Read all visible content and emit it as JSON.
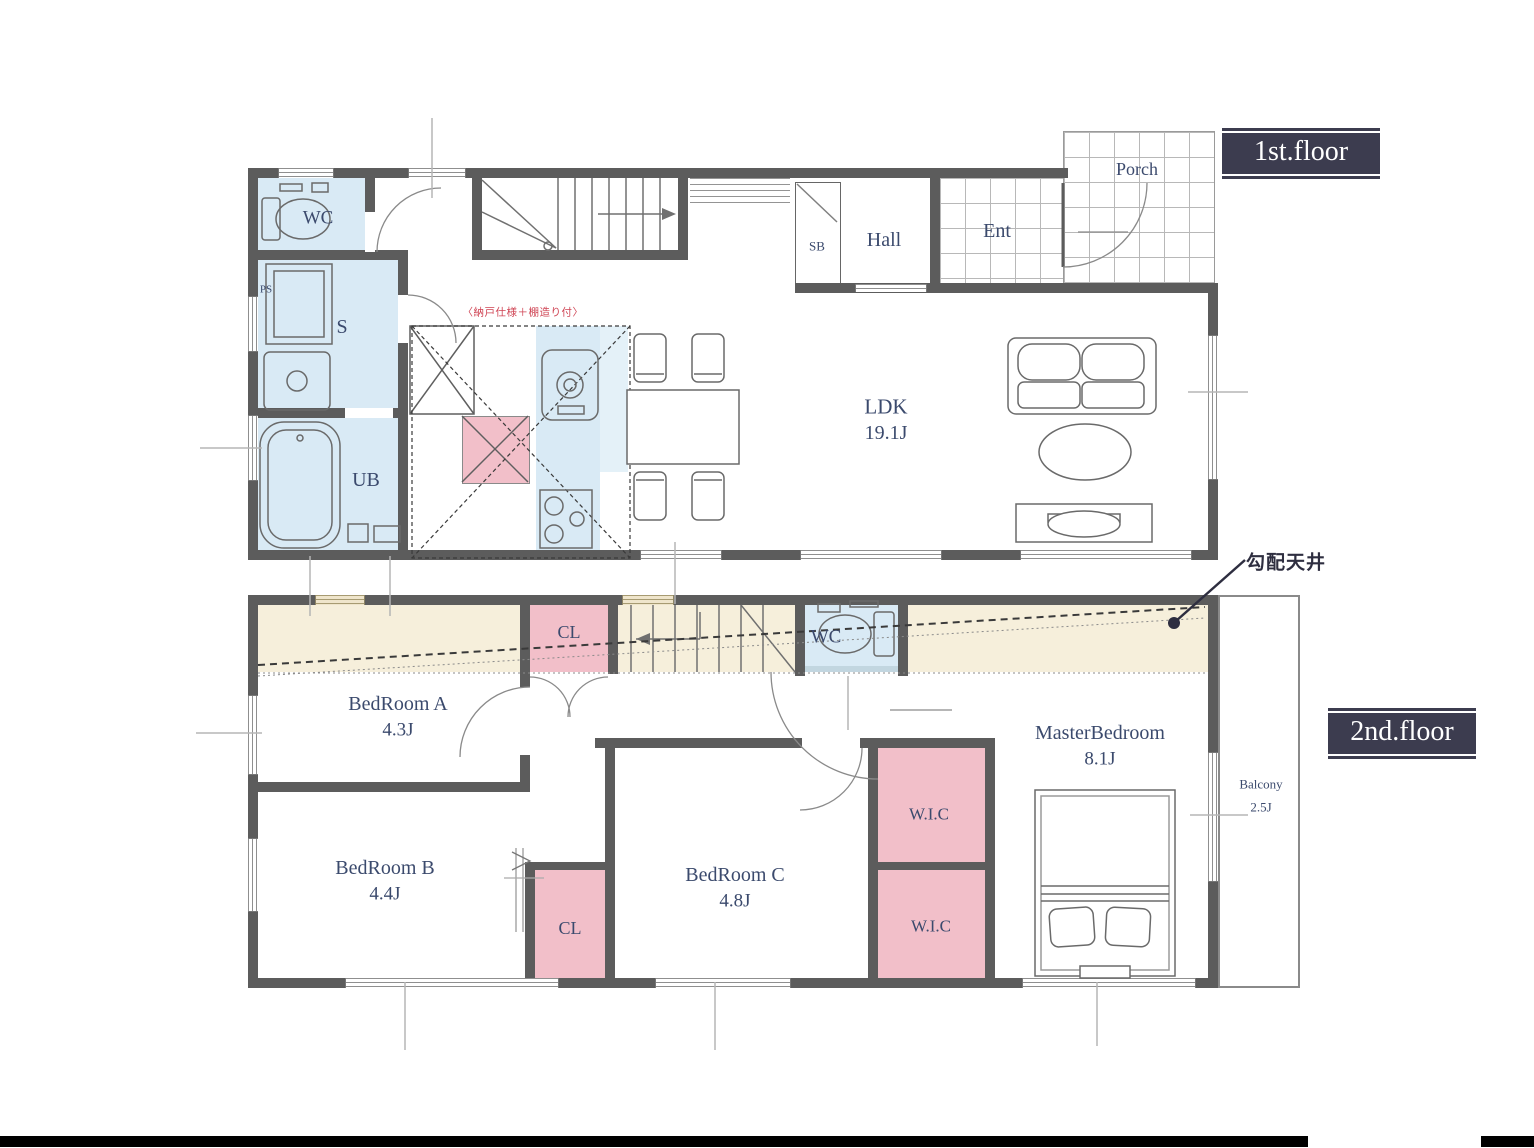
{
  "f1": {
    "badge": "1st.floor",
    "wc": "WC",
    "ps": "PS",
    "s": "S",
    "ub": "UB",
    "sb": "SB",
    "hall": "Hall",
    "ent": "Ent",
    "porch": "Porch",
    "ldk_name": "LDK",
    "ldk_size": "19.1J",
    "red_note": "〈納戸仕様＋棚造り付〉"
  },
  "f2": {
    "badge": "2nd.floor",
    "cl_upper": "CL",
    "cl_lower": "CL",
    "wc": "WC",
    "bedroom_a_name": "BedRoom A",
    "bedroom_a_size": "4.3J",
    "bedroom_b_name": "BedRoom B",
    "bedroom_b_size": "4.4J",
    "bedroom_c_name": "BedRoom C",
    "bedroom_c_size": "4.8J",
    "master_name": "MasterBedroom",
    "master_size": "8.1J",
    "wic_upper": "W.I.C",
    "wic_lower": "W.I.C",
    "balcony_name": "Balcony",
    "balcony_size": "2.5J",
    "sloped_note": "勾配天井"
  },
  "colors": {
    "wall": "#5c5c5c",
    "water_room": "#d9eaf5",
    "water_light": "#e4f1f8",
    "storage_pink": "#f2bfc9",
    "sloped_beige": "#f6efdb",
    "window_tan": "#efe5cb",
    "badge_bg": "#3c3c4f",
    "label_navy": "#3b4a6d",
    "note_red": "#cf4353",
    "leader_navy": "#2e2e40",
    "bottom_bar": "#000000"
  }
}
